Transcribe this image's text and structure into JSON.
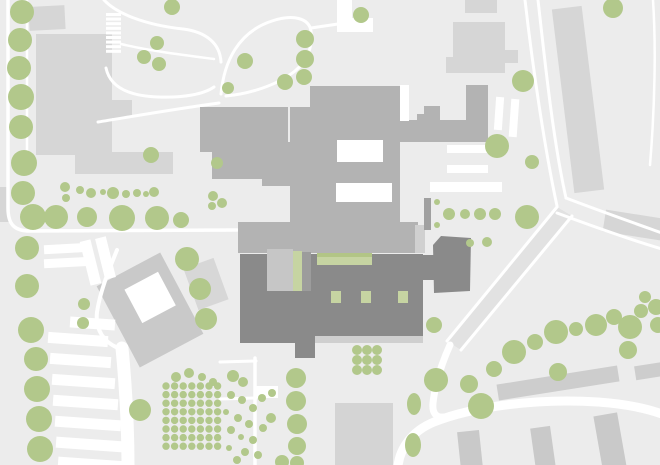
{
  "canvas": {
    "width": 660,
    "height": 465
  },
  "colors": {
    "background": "#ececec",
    "road": "#ffffff",
    "context": "#d6d6d6",
    "context_dark": "#c9c9c9",
    "main": "#b3b3b3",
    "dark": "#8a8a8a",
    "dark_strip": "#cfcfcf",
    "green": "#c6d4a2",
    "green_dark": "#b2c586",
    "tree": "#b2c88b",
    "road_fill": "#e2e2e2"
  },
  "map": {
    "context_buildings": [
      {
        "x": 29,
        "y": 6,
        "w": 36,
        "h": 24,
        "r": -3
      },
      {
        "x": 36,
        "y": 34,
        "w": 76,
        "h": 121
      },
      {
        "x": 110,
        "y": 100,
        "w": 22,
        "h": 18
      },
      {
        "x": 75,
        "y": 152,
        "w": 98,
        "h": 22
      },
      {
        "x": 0,
        "y": 187,
        "w": 9,
        "h": 35
      },
      {
        "x": 465,
        "y": 0,
        "w": 32,
        "h": 13
      },
      {
        "x": 453,
        "y": 22,
        "w": 52,
        "h": 51
      },
      {
        "x": 505,
        "y": 50,
        "w": 13,
        "h": 13
      },
      {
        "x": 446,
        "y": 57,
        "w": 8,
        "h": 16
      },
      {
        "x": 563,
        "y": 7,
        "w": 30,
        "h": 185,
        "r": -7
      },
      {
        "x": 604,
        "y": 214,
        "w": 58,
        "h": 22,
        "r": 9
      },
      {
        "x": 190,
        "y": 262,
        "w": 32,
        "h": 44,
        "r": -20,
        "f": "#d7d7d7"
      },
      {
        "x": 114,
        "y": 264,
        "w": 72,
        "h": 92,
        "r": -28,
        "px": 150,
        "py": 310,
        "f": "#c9c9c9"
      },
      {
        "x": 137,
        "y": 280,
        "w": 38,
        "h": 38,
        "r": -28,
        "px": 150,
        "py": 310,
        "f": "#ffffff"
      },
      {
        "x": 335,
        "y": 403,
        "w": 58,
        "h": 62,
        "f": "#d4d4d4"
      },
      {
        "x": 497,
        "y": 375,
        "w": 122,
        "h": 16,
        "r": -9,
        "f": "#cdcdcd"
      },
      {
        "x": 635,
        "y": 364,
        "w": 30,
        "h": 14,
        "r": -9,
        "f": "#cdcdcd"
      },
      {
        "x": 459,
        "y": 431,
        "w": 22,
        "h": 38,
        "r": -6,
        "f": "#c9c9c9"
      },
      {
        "x": 533,
        "y": 427,
        "w": 20,
        "h": 42,
        "r": -8,
        "f": "#c9c9c9"
      },
      {
        "x": 598,
        "y": 414,
        "w": 24,
        "h": 55,
        "r": -10,
        "f": "#c9c9c9"
      }
    ],
    "road_fills": [
      {
        "p": "557,207 572,216 461,350 447,341"
      }
    ],
    "plaza": {
      "p": "337,0 352,0 352,18 373,18 373,32 337,32"
    },
    "roads": [
      {
        "d": "M 8,0 L 8,208 C 8,224 14,231 30,231 L 237,230",
        "w": 3.5
      },
      {
        "d": "M 27,0 L 27,152",
        "w": 2.5
      },
      {
        "d": "M 104,0 C 117,14 146,25 183,29 C 207,32 220,44 221,62",
        "w": 3
      },
      {
        "d": "M 121,44 C 150,51 183,55 214,59",
        "w": 2.5
      },
      {
        "d": "M 221,94 C 224,62 238,32 272,21 C 293,14 309,18 311,31 C 313,47 307,61 295,71 C 276,86 248,94 226,96",
        "w": 3
      },
      {
        "d": "M 311,28 L 338,24",
        "w": 3
      },
      {
        "d": "M 106,68 C 110,87 129,96 158,97 C 184,98 204,94 214,87",
        "w": 3
      },
      {
        "d": "M 98,122 C 135,116 175,109 219,103",
        "w": 3
      },
      {
        "d": "M 525,0 C 533,70 545,150 557,206",
        "w": 3
      },
      {
        "d": "M 538,0 C 545,62 553,140 566,198",
        "w": 3
      },
      {
        "d": "M 566,198 C 600,211 634,223 662,233",
        "w": 3
      },
      {
        "d": "M 557,213 C 592,226 628,239 662,249",
        "w": 3
      },
      {
        "d": "M 557,207 L 447,341",
        "w": 3
      },
      {
        "d": "M 572,216 L 461,350",
        "w": 3
      },
      {
        "d": "M 450,345 C 441,365 435,385 433,403 C 432,413 436,418 444,417",
        "w": 7
      },
      {
        "d": "M 398,466 C 400,448 412,431 434,422 C 474,406 540,398 598,402 C 626,404 648,409 662,414",
        "w": 9
      },
      {
        "d": "M 653,0 C 656,45 655,105 650,165",
        "w": 2.5
      },
      {
        "d": "M 255,358 L 255,466",
        "w": 3.5
      },
      {
        "d": "M 220,362 L 256,361",
        "w": 3
      },
      {
        "d": "M 220,399 L 256,398",
        "w": 3
      },
      {
        "d": "M 117,250 C 108,272 100,292 97,312 C 95,330 104,342 118,348",
        "w": 4
      },
      {
        "d": "M 122,348 C 126,390 128,430 128,466",
        "w": 13
      }
    ],
    "parking_bars": [
      {
        "x": 447,
        "y": 145,
        "w": 45,
        "h": 8
      },
      {
        "x": 447,
        "y": 165,
        "w": 41,
        "h": 8
      },
      {
        "x": 430,
        "y": 182,
        "w": 72,
        "h": 10
      },
      {
        "x": 495,
        "y": 97,
        "w": 8,
        "h": 33,
        "r": 4
      },
      {
        "x": 510,
        "y": 99,
        "w": 8,
        "h": 38,
        "r": 4
      },
      {
        "x": 44,
        "y": 244,
        "w": 46,
        "h": 9,
        "r": -3
      },
      {
        "x": 44,
        "y": 258,
        "w": 48,
        "h": 9,
        "r": -3
      },
      {
        "x": 85,
        "y": 240,
        "w": 11,
        "h": 45,
        "r": -14
      },
      {
        "x": 100,
        "y": 237,
        "w": 11,
        "h": 42,
        "r": -14
      },
      {
        "x": 70,
        "y": 318,
        "w": 45,
        "h": 11,
        "r": 4
      },
      {
        "x": 48,
        "y": 334,
        "w": 60,
        "h": 11,
        "r": 4
      },
      {
        "x": 50,
        "y": 355,
        "w": 61,
        "h": 11,
        "r": 4
      },
      {
        "x": 52,
        "y": 376,
        "w": 63,
        "h": 11,
        "r": 4
      },
      {
        "x": 53,
        "y": 397,
        "w": 65,
        "h": 11,
        "r": 4
      },
      {
        "x": 55,
        "y": 418,
        "w": 66,
        "h": 11,
        "r": 4
      },
      {
        "x": 56,
        "y": 439,
        "w": 67,
        "h": 11,
        "r": 4
      },
      {
        "x": 58,
        "y": 459,
        "w": 68,
        "h": 11,
        "r": 4
      },
      {
        "x": 256,
        "y": 386,
        "w": 22,
        "h": 12
      }
    ],
    "hatch": {
      "x": 106,
      "y": 13,
      "w": 15,
      "h": 3,
      "count": 9,
      "dy": 4.6
    },
    "main_building": {
      "rects": [
        {
          "x": 310,
          "y": 86,
          "w": 92,
          "h": 26
        },
        {
          "x": 383,
          "y": 120,
          "w": 105,
          "h": 22
        },
        {
          "x": 424,
          "y": 106,
          "w": 16,
          "h": 16
        },
        {
          "x": 417,
          "y": 114,
          "w": 8,
          "h": 9
        },
        {
          "x": 466,
          "y": 85,
          "w": 22,
          "h": 37
        },
        {
          "x": 262,
          "y": 142,
          "w": 30,
          "h": 44
        },
        {
          "x": 290,
          "y": 107,
          "w": 110,
          "h": 115
        },
        {
          "x": 238,
          "y": 222,
          "w": 180,
          "h": 31
        },
        {
          "x": 380,
          "y": 96,
          "w": 8,
          "h": 10
        },
        {
          "x": 388,
          "y": 142,
          "w": 10,
          "h": 6
        },
        {
          "x": 415,
          "y": 225,
          "w": 10,
          "h": 28,
          "f": "#d0d0d0"
        },
        {
          "x": 424,
          "y": 198,
          "w": 7,
          "h": 32,
          "f": "#a0a0a0"
        }
      ],
      "polys": [
        {
          "p": "200,107 288,107 288,142 267,142 267,179 212,179 212,152 200,152"
        }
      ],
      "courtyards": [
        {
          "x": 337,
          "y": 140,
          "w": 46,
          "h": 22
        },
        {
          "x": 336,
          "y": 183,
          "w": 56,
          "h": 19
        },
        {
          "x": 400,
          "y": 85,
          "w": 9,
          "h": 36
        }
      ]
    },
    "dark_building": {
      "rects": [
        {
          "x": 240,
          "y": 254,
          "w": 183,
          "h": 82
        },
        {
          "x": 240,
          "y": 290,
          "w": 58,
          "h": 53
        },
        {
          "x": 295,
          "y": 336,
          "w": 20,
          "h": 22
        },
        {
          "x": 421,
          "y": 255,
          "w": 13,
          "h": 25
        }
      ],
      "polys": [
        {
          "p": "433,245 441,236 471,238 470,291 434,293"
        }
      ],
      "details": [
        {
          "x": 315,
          "y": 336,
          "w": 108,
          "h": 7,
          "f": "#cfcfcf"
        },
        {
          "x": 267,
          "y": 249,
          "w": 26,
          "h": 42,
          "f": "#c6c6c6"
        },
        {
          "x": 302,
          "y": 252,
          "w": 9,
          "h": 39,
          "f": "#9c9c9c"
        }
      ]
    },
    "green_accents": [
      {
        "x": 293,
        "y": 251,
        "w": 9,
        "h": 40
      },
      {
        "x": 317,
        "y": 253,
        "w": 55,
        "h": 12
      },
      {
        "x": 317,
        "y": 253,
        "w": 55,
        "h": 4,
        "f": "#b2c586"
      },
      {
        "x": 331,
        "y": 291,
        "w": 10,
        "h": 12
      },
      {
        "x": 361,
        "y": 291,
        "w": 10,
        "h": 12
      },
      {
        "x": 398,
        "y": 291,
        "w": 10,
        "h": 12
      }
    ],
    "trees": [
      [
        22,
        12,
        12
      ],
      [
        20,
        40,
        12
      ],
      [
        19,
        68,
        12
      ],
      [
        21,
        97,
        13
      ],
      [
        21,
        127,
        12
      ],
      [
        24,
        163,
        13
      ],
      [
        23,
        193,
        12
      ],
      [
        33,
        217,
        13
      ],
      [
        56,
        217,
        12
      ],
      [
        27,
        248,
        12
      ],
      [
        27,
        286,
        12
      ],
      [
        31,
        330,
        13
      ],
      [
        36,
        359,
        12
      ],
      [
        37,
        389,
        13
      ],
      [
        39,
        419,
        13
      ],
      [
        40,
        449,
        13
      ],
      [
        65,
        187,
        5
      ],
      [
        66,
        198,
        4
      ],
      [
        80,
        190,
        4
      ],
      [
        91,
        193,
        5
      ],
      [
        103,
        192,
        3
      ],
      [
        113,
        193,
        6
      ],
      [
        126,
        194,
        4
      ],
      [
        137,
        193,
        4
      ],
      [
        146,
        194,
        3
      ],
      [
        154,
        192,
        5
      ],
      [
        87,
        217,
        10
      ],
      [
        122,
        218,
        13
      ],
      [
        157,
        218,
        12
      ],
      [
        181,
        220,
        8
      ],
      [
        187,
        259,
        12
      ],
      [
        200,
        289,
        11
      ],
      [
        206,
        319,
        11
      ],
      [
        84,
        304,
        6
      ],
      [
        83,
        323,
        6
      ],
      [
        213,
        196,
        5
      ],
      [
        222,
        203,
        5
      ],
      [
        212,
        206,
        4
      ],
      [
        151,
        155,
        8
      ],
      [
        217,
        163,
        6
      ],
      [
        245,
        61,
        8
      ],
      [
        285,
        82,
        8
      ],
      [
        228,
        88,
        6
      ],
      [
        305,
        39,
        9
      ],
      [
        305,
        59,
        9
      ],
      [
        304,
        77,
        8
      ],
      [
        361,
        15,
        8
      ],
      [
        172,
        7,
        8
      ],
      [
        157,
        43,
        7
      ],
      [
        144,
        57,
        7
      ],
      [
        159,
        64,
        7
      ],
      [
        497,
        146,
        12
      ],
      [
        523,
        81,
        11
      ],
      [
        613,
        8,
        10
      ],
      [
        532,
        162,
        7
      ],
      [
        437,
        202,
        3
      ],
      [
        449,
        214,
        6
      ],
      [
        465,
        214,
        5
      ],
      [
        480,
        214,
        6
      ],
      [
        495,
        214,
        6
      ],
      [
        437,
        225,
        3
      ],
      [
        527,
        217,
        12
      ],
      [
        470,
        243,
        4
      ],
      [
        487,
        242,
        5
      ],
      [
        434,
        325,
        8
      ],
      [
        296,
        378,
        10
      ],
      [
        296,
        401,
        10
      ],
      [
        297,
        424,
        10
      ],
      [
        297,
        446,
        9
      ],
      [
        282,
        462,
        7
      ],
      [
        297,
        463,
        7
      ],
      [
        233,
        376,
        6
      ],
      [
        243,
        382,
        5
      ],
      [
        231,
        395,
        4
      ],
      [
        242,
        400,
        4
      ],
      [
        253,
        408,
        4
      ],
      [
        226,
        412,
        3
      ],
      [
        238,
        418,
        4
      ],
      [
        249,
        424,
        4
      ],
      [
        231,
        430,
        4
      ],
      [
        241,
        437,
        3
      ],
      [
        253,
        440,
        4
      ],
      [
        229,
        448,
        3
      ],
      [
        245,
        452,
        4
      ],
      [
        237,
        460,
        4
      ],
      [
        258,
        455,
        4
      ],
      [
        263,
        428,
        4
      ],
      [
        271,
        418,
        5
      ],
      [
        262,
        398,
        4
      ],
      [
        272,
        393,
        4
      ],
      [
        176,
        377,
        5
      ],
      [
        189,
        373,
        5
      ],
      [
        202,
        377,
        4
      ],
      [
        213,
        382,
        4
      ],
      [
        140,
        410,
        11
      ],
      [
        436,
        380,
        12
      ],
      [
        481,
        406,
        13
      ],
      [
        469,
        384,
        9
      ],
      [
        494,
        369,
        8
      ],
      [
        514,
        352,
        12
      ],
      [
        535,
        342,
        8
      ],
      [
        556,
        332,
        12
      ],
      [
        576,
        329,
        7
      ],
      [
        596,
        325,
        11
      ],
      [
        614,
        317,
        8
      ],
      [
        630,
        327,
        12
      ],
      [
        641,
        311,
        7
      ],
      [
        628,
        350,
        9
      ],
      [
        658,
        325,
        8
      ],
      [
        645,
        297,
        6
      ],
      [
        656,
        307,
        8
      ],
      [
        558,
        372,
        9
      ],
      [
        357,
        350,
        5
      ],
      [
        367,
        350,
        5
      ],
      [
        377,
        350,
        5
      ],
      [
        357,
        360,
        5
      ],
      [
        367,
        360,
        5
      ],
      [
        377,
        360,
        5
      ],
      [
        357,
        370,
        5
      ],
      [
        367,
        370,
        5
      ],
      [
        377,
        370,
        5
      ]
    ],
    "tree_ellipses": [
      [
        414,
        404,
        7,
        11
      ],
      [
        413,
        445,
        8,
        12
      ]
    ],
    "grove_grid": {
      "x0": 166,
      "y0": 386,
      "dx": 8.6,
      "dy": 8.6,
      "cols": 7,
      "rows": 8,
      "r": 3.7
    }
  }
}
